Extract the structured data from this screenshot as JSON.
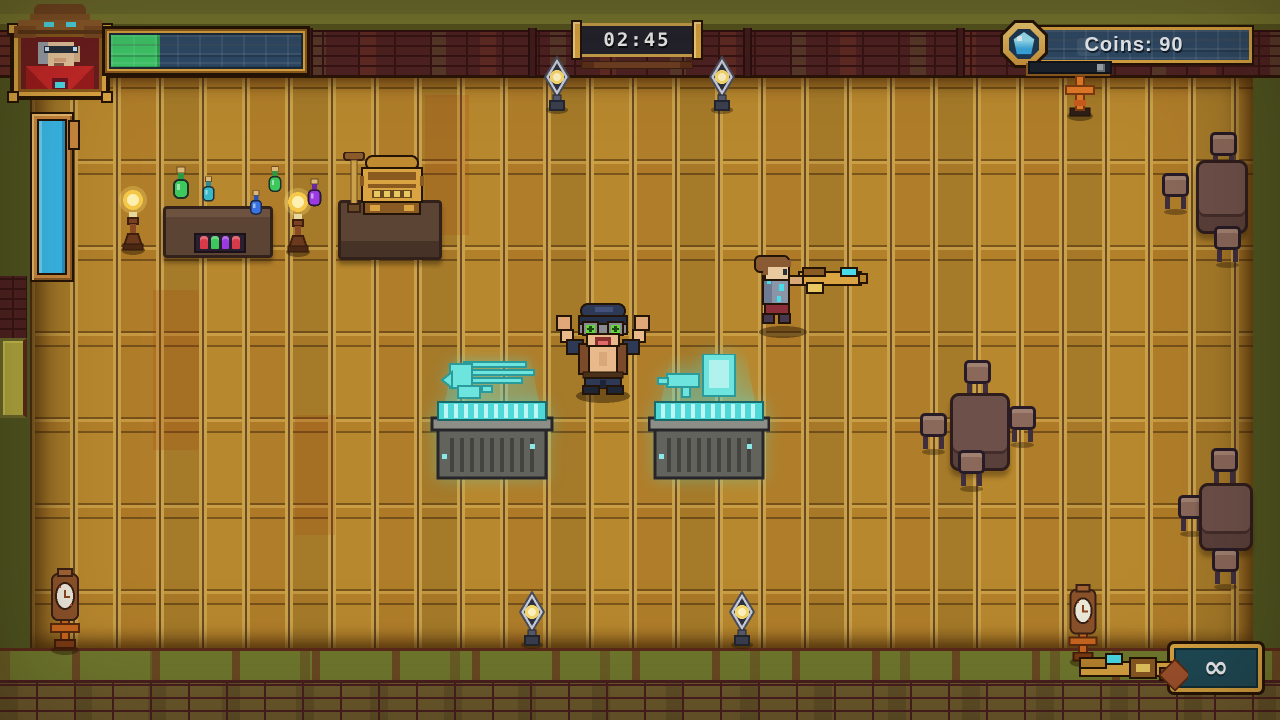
{
  "hud": {
    "portrait": {
      "icon": "cowboy-portrait"
    },
    "health_bar": {
      "fill_percent": 26,
      "fill_color": "#3ec96a",
      "track_color": "#2e4a66"
    },
    "charge_meter": {
      "fill_percent": 100,
      "fill_color": "#38b8e8"
    },
    "timer": {
      "value": "02:45"
    },
    "coins": {
      "label": "Coins: 90",
      "icon": "blue-gem-coin-icon"
    },
    "ammo": {
      "value": "∞",
      "icon": "golden-rifle-icon"
    }
  },
  "world": {
    "shopkeeper": "goggled shopkeeper with raised arms",
    "player": "armored gunslinger aiming golden rifle",
    "display_case_left_item": "hologram minigun",
    "display_case_right_item": "hologram blaster and crate",
    "shop_props": [
      "potion bottles",
      "cash register",
      "plunger detonator",
      "candle lamps"
    ],
    "furniture": [
      "tables with stools",
      "grandfather clocks",
      "lanterns",
      "wall candelabra",
      "blue charge meter",
      "side door"
    ]
  },
  "colors": {
    "hud_gold": "#d9a441",
    "outline_dark": "#241405",
    "panel_navy": "#2e4a66",
    "health_green": "#3ec96a",
    "meter_blue": "#38b8e8",
    "hologram_cyan": "#5ae0e0",
    "ammo_teal": "#1d4a57",
    "floor_amber": "#b8882e",
    "wall_brick_red": "#4e2222",
    "outer_olive": "#4f5520",
    "accent_cyan": "#4adbe8"
  }
}
